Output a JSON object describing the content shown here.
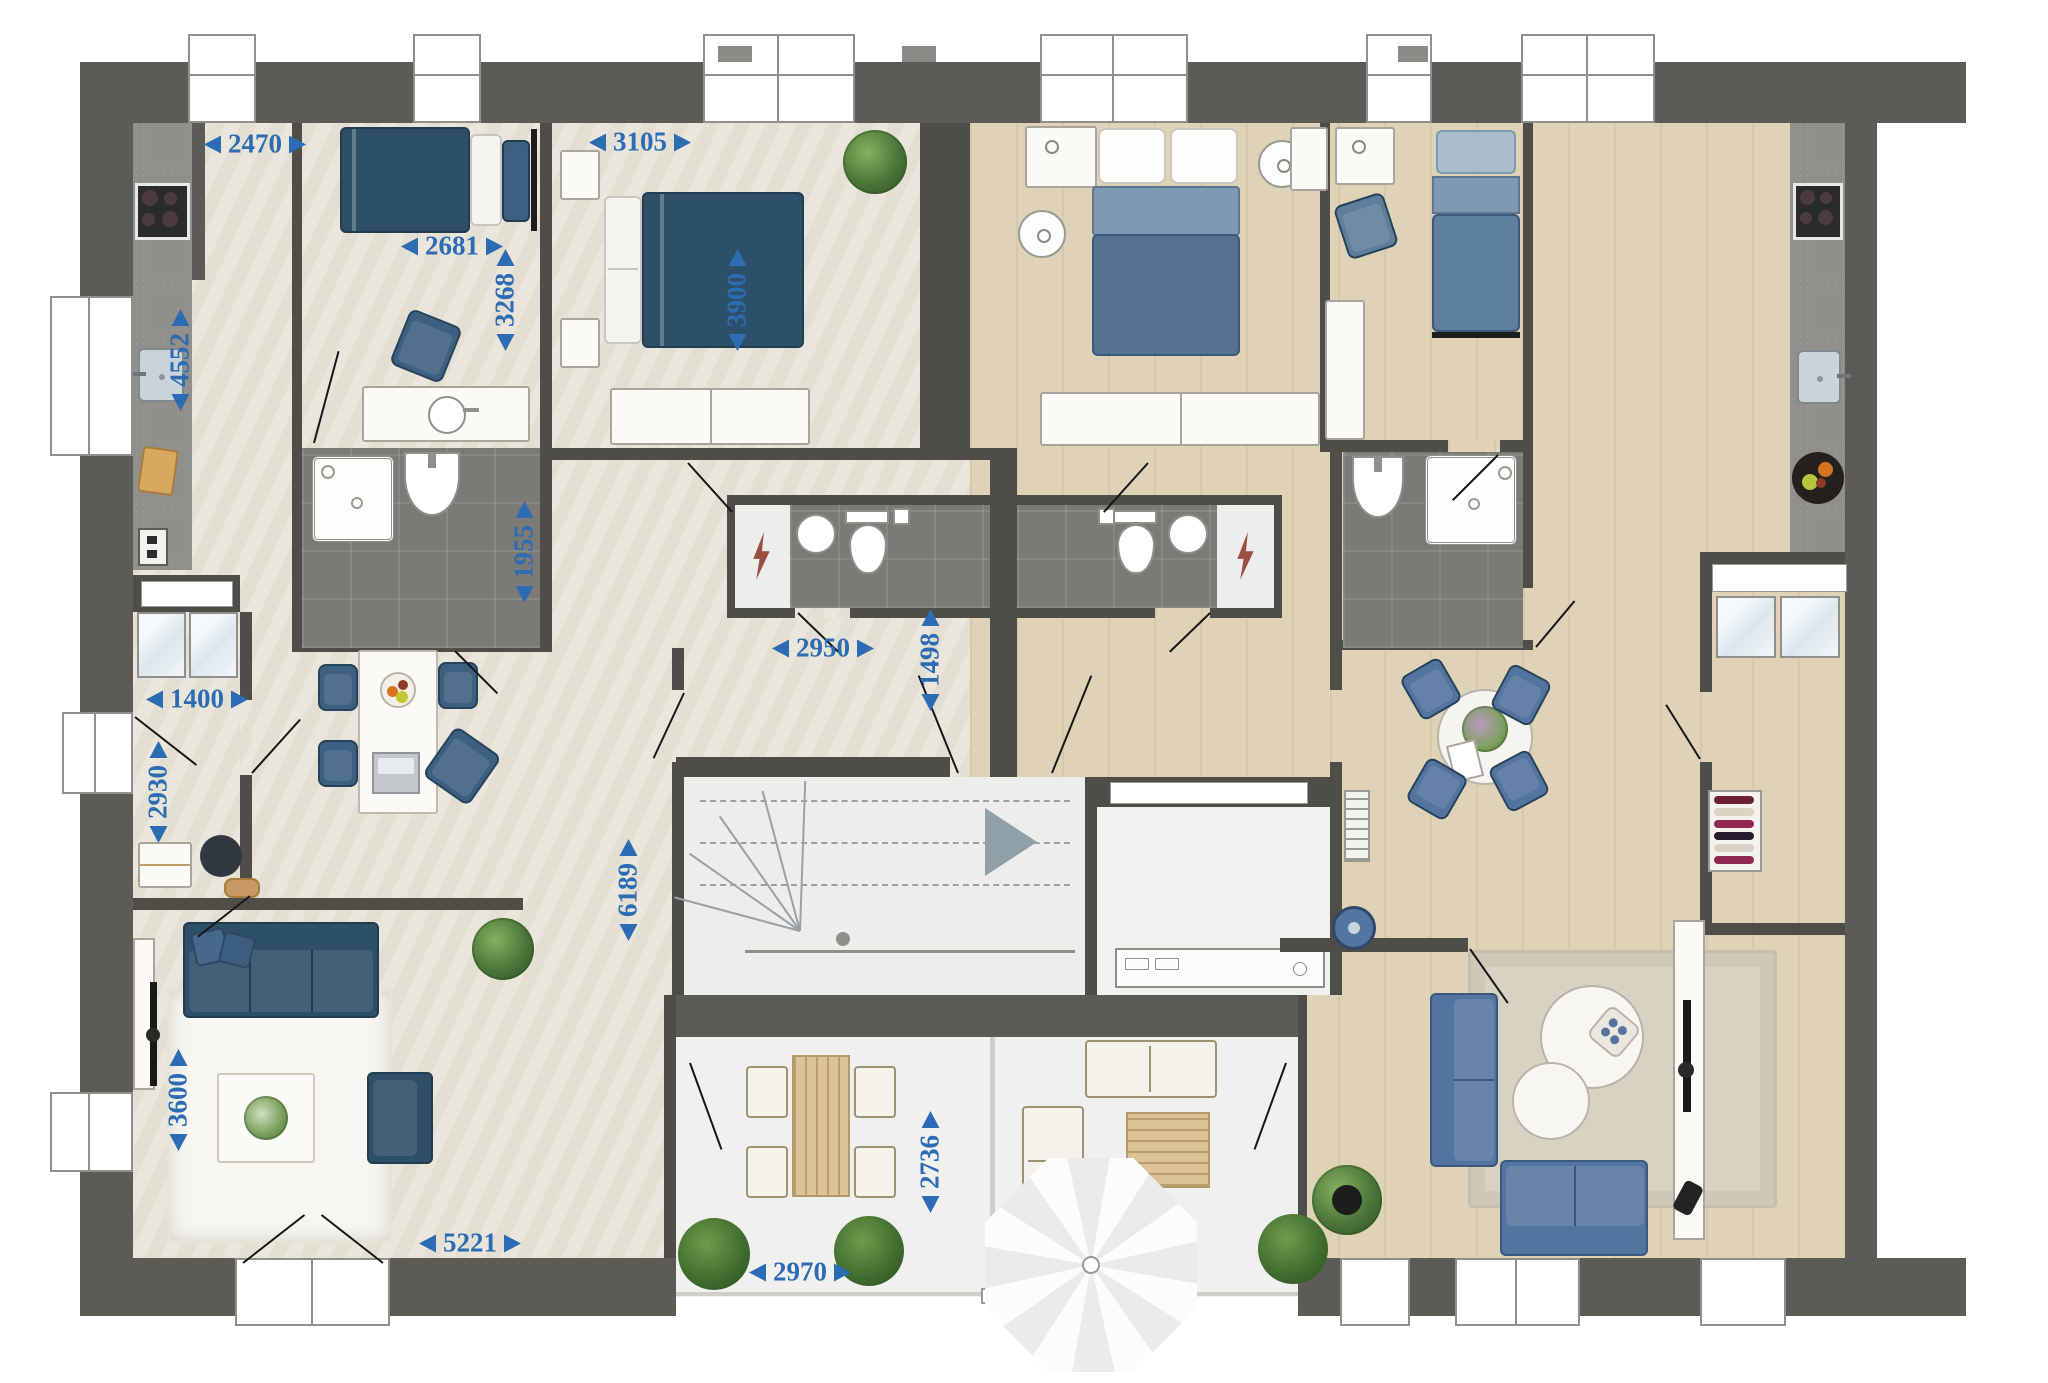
{
  "plan": {
    "dimension_color": "#2b6cb4",
    "wall_color": "#5d5b55",
    "floor_left_color": "#e9e5d9",
    "floor_right_color": "#dfd2b6",
    "bathroom_tile_color": "#7b7a74",
    "furniture_blue_left": "#2e4f68",
    "furniture_blue_right": "#53749e",
    "dimensions_mm": {
      "kitchen_width": "2470",
      "kitchen_length": "4552",
      "bedroom1_width": "2681",
      "bedroom1_depth": "3268",
      "bedroom2_width": "3105",
      "bedroom2_depth": "3900",
      "bathroom1_depth": "1955",
      "entry_width": "1400",
      "entry_depth": "2930",
      "hall_width": "2950",
      "hall_depth": "1498",
      "corridor_length": "6189",
      "living_depth": "3600",
      "living_width": "5221",
      "terrace_width": "2970",
      "terrace_depth": "2736"
    },
    "icons": [
      "stove-icon",
      "sink-icon",
      "shower-icon",
      "toilet-icon",
      "washbasin-icon",
      "lightning-icon",
      "stairs-icon",
      "plant-icon",
      "umbrella-icon",
      "wine-rack-icon",
      "fruit-bowl-icon",
      "tv-icon",
      "robot-vacuum-icon",
      "laptop-icon",
      "lamp-icon",
      "dim-arrow-icon"
    ]
  }
}
